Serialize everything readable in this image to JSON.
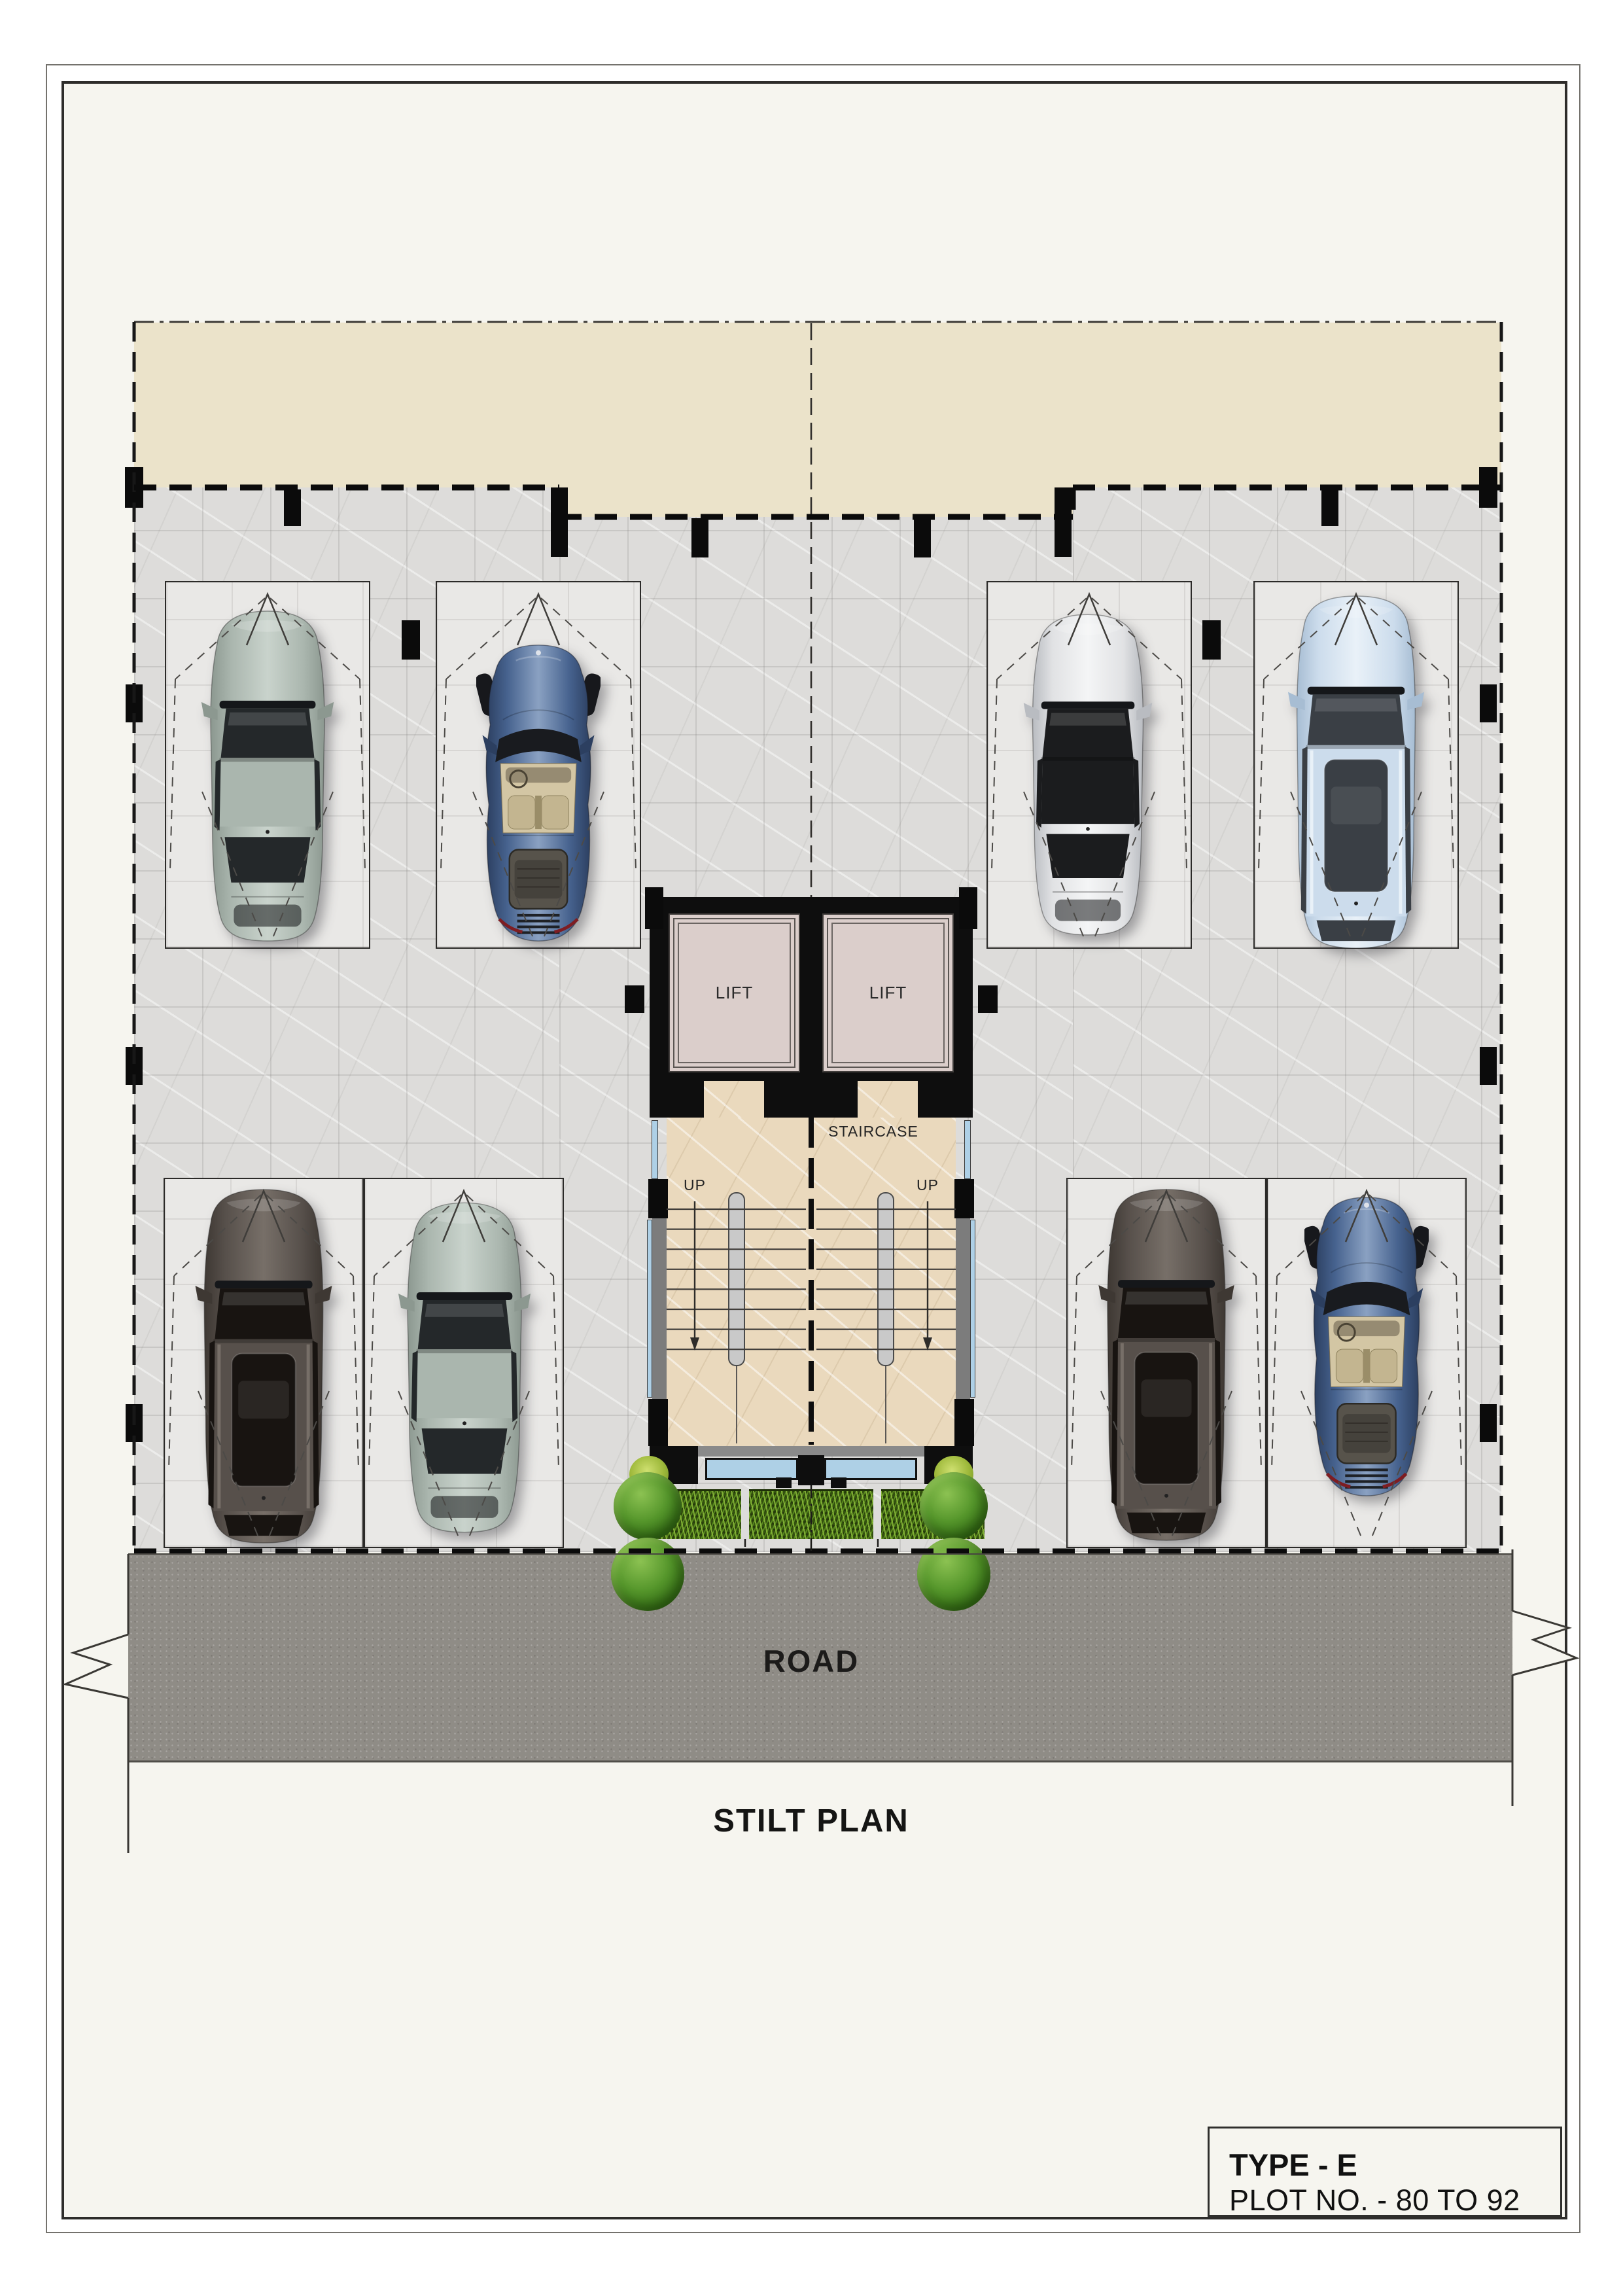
{
  "labels": {
    "road": "ROAD",
    "sheet_title": "STILT PLAN",
    "lift_left": "LIFT",
    "lift_right": "LIFT",
    "staircase": "STAIRCASE",
    "up_left": "UP",
    "up_right": "UP"
  },
  "title_block": {
    "type_line": "TYPE - E",
    "plot_line": "PLOT NO. - 80 TO 92"
  },
  "colors": {
    "page": "#f6f5ef",
    "setback_beige": "#ebe3ca",
    "slab_gray": "#dddcda",
    "road_gray": "#8f8c86",
    "core_black": "#0e0e0e",
    "lift_cab_pink": "#dbcecb",
    "stair_floor_beige": "#ead9bd",
    "hedge_green": "#33500f",
    "glazing_blue": "#aed0e6",
    "line_dark": "#171717"
  },
  "cars": [
    {
      "name": "sage-green-sedan",
      "type": "sedan",
      "bay": "tl1",
      "body": "#aab6ae",
      "dark": "#8c9890",
      "light": "#c9d3cc",
      "glass": "#24282a",
      "interior": "#6d7570",
      "glass_roof": false
    },
    {
      "name": "navy-blue-sports-car",
      "type": "sports",
      "bay": "tl2",
      "body": "#46628e",
      "dark": "#2c3f60",
      "light": "#8aa1c2",
      "glass": "#1c2026",
      "interior": "#d3c6a4",
      "glass_roof": false
    },
    {
      "name": "silver-white-sedan",
      "type": "sedan",
      "bay": "tr1",
      "body": "#e1e2e4",
      "dark": "#b9bcc1",
      "light": "#f4f5f6",
      "glass": "#1b1c1e",
      "interior": "#3a3b3e",
      "glass_roof": true
    },
    {
      "name": "pale-blue-suv",
      "type": "suv",
      "bay": "tr2",
      "body": "#ccdcec",
      "dark": "#a7bdd3",
      "light": "#e9f1f8",
      "glass": "#3a3f45",
      "interior": "#8e8678",
      "glass_roof": true
    },
    {
      "name": "dark-brown-suv",
      "type": "suv",
      "bay": "bl1",
      "body": "#57504b",
      "dark": "#3e3833",
      "light": "#776f68",
      "glass": "#181411",
      "interior": "#2a2522",
      "glass_roof": false
    },
    {
      "name": "sage-green-sedan",
      "type": "sedan",
      "bay": "bl2",
      "body": "#aab6ae",
      "dark": "#8c9890",
      "light": "#c9d3cc",
      "glass": "#24282a",
      "interior": "#6d7570",
      "glass_roof": false
    },
    {
      "name": "dark-brown-suv",
      "type": "suv",
      "bay": "br1",
      "body": "#57504b",
      "dark": "#3e3833",
      "light": "#776f68",
      "glass": "#181411",
      "interior": "#2a2522",
      "glass_roof": false
    },
    {
      "name": "navy-blue-sports-car",
      "type": "sports",
      "bay": "br2",
      "body": "#46628e",
      "dark": "#2c3f60",
      "light": "#8aa1c2",
      "glass": "#1c2026",
      "interior": "#d3c6a4",
      "glass_roof": false
    }
  ]
}
